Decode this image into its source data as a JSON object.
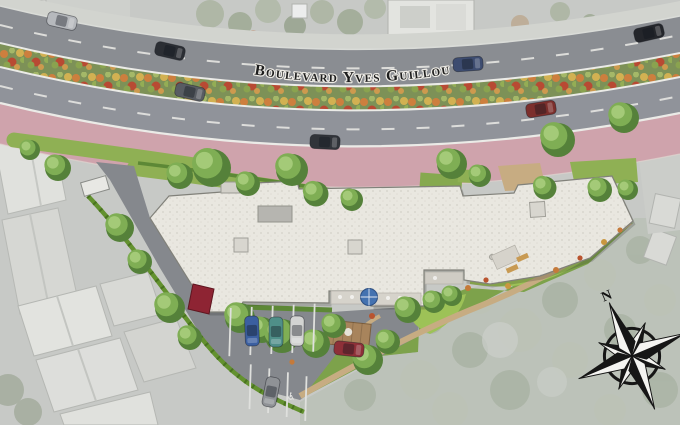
{
  "street": {
    "label": "Boulevard Yves Guillou"
  },
  "compass": {
    "north_label": "N"
  },
  "colors": {
    "asphalt_upper": "#8a8d92",
    "asphalt_main": "#90939a",
    "sidewalk": "#d2d4cf",
    "lane_marking": "#ebebe7",
    "median_base": "#7d9157",
    "flower_orange": "#cd7f3e",
    "flower_red": "#b84a33",
    "flower_yellow": "#d2b152",
    "cycle_path_pink": "#cfa3ac",
    "site_lawn": "#8fb054",
    "garden_green": "#7da24b",
    "bright_lawn": "#9dc257",
    "hedge_green": "#63912f",
    "parking_asphalt": "#85888d",
    "building_roof": "#e9e7e0",
    "building_edge": "#81817a",
    "path_tan": "#c7ac82",
    "canopy_red": "#8e2433",
    "parasol_blue": "#4472b0",
    "surround_base": "#c7c9c6",
    "surround_roof": "#dfe0dc",
    "surround_trees": "#aeb6a7",
    "street_text": "#1d1d1d",
    "compass_ink": "#161616"
  }
}
